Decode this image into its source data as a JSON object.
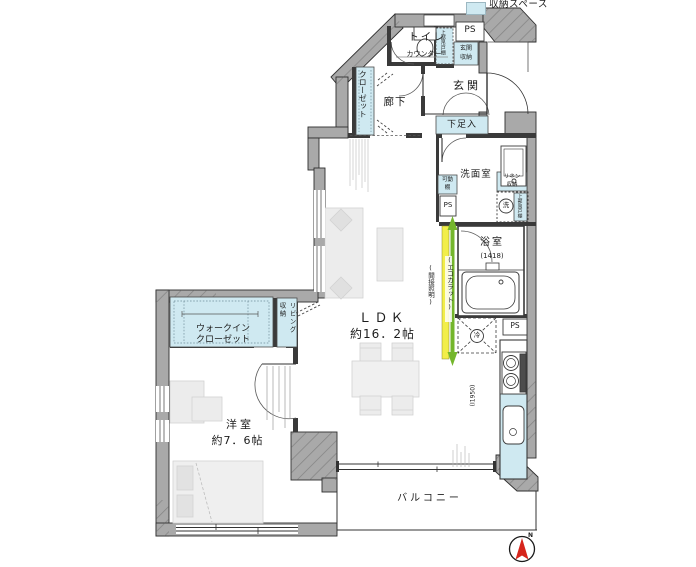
{
  "legend": {
    "label": "収納スペース"
  },
  "labels": {
    "toilet": "トイレ",
    "counter": "カウンター",
    "upper_cabinet_entrance": "上部吊戸棚",
    "ps_top": "PS",
    "entrance_storage_1": "玄関",
    "entrance_storage_2": "収納",
    "entrance": "玄関",
    "shoe_cabinet": "下足入",
    "hallway": "廊下",
    "closet": "クローゼット",
    "washroom": "洗面室",
    "linen_1": "リネン",
    "linen_2": "収納",
    "shelf_1": "可動",
    "shelf_2": "棚",
    "ps_washroom": "PS",
    "washer": "洗",
    "upper_cabinet_washroom": "上部吊戸棚",
    "bathroom": "浴室",
    "bathroom_size": "(1418)",
    "ecocarat": "(エコカラット)",
    "indirect_light": "(間接照明)",
    "ldk": "ＬＤＫ",
    "ldk_size": "約16．2帖",
    "fridge": "冷",
    "ps_kitchen": "PS",
    "kitchen_size": "(I1950)",
    "wic_1": "ウォークイン",
    "wic_2": "クローゼット",
    "living_storage": "リビング収納",
    "western_room": "洋室",
    "western_room_size": "約7．6帖",
    "balcony": "バルコニー",
    "compass_north": "N"
  },
  "colors": {
    "storage_fill": "#cfe9f1",
    "wall_fill": "#a9a9a9",
    "ecocarat_strip": "#f2ee49",
    "arrow_green": "#74b62c",
    "compass_red": "#d6251c"
  }
}
